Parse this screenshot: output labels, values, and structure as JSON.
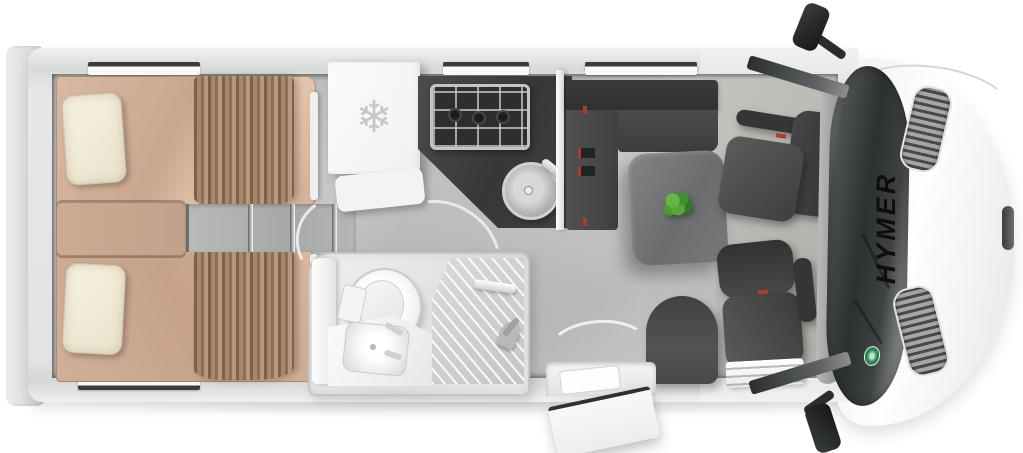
{
  "brand": {
    "label": "HYMER"
  },
  "fridge": {
    "icon_glyph": "❄"
  },
  "zones": {
    "vehicle": "Hymer motorhome top-view floor plan",
    "rear_bed_top": "Single bed with pillow and curtain",
    "rear_bed_bottom": "Single bed with pillow and curtain",
    "bed_steps": "Steps between twin beds",
    "fridge": "Refrigerator with freezer symbol",
    "kitchen": "Kitchen block with 3-burner gas hob and round sink",
    "bathroom": "Bathroom with toilet, washbasin and shower",
    "lounge": "L-shaped lounge seating with table and plant",
    "single_seat": "Single seat beside entry door",
    "swivel_seat_top": "Swivelled cab seat",
    "swivel_seat_bottom": "Swivelled cab seat",
    "entry_door": "Open entry door with step",
    "cab": "Driver cab with windshield and hood",
    "mirror_top": "Side mirror",
    "mirror_bottom": "Side mirror"
  },
  "colors": {
    "body_white": "#f4f5f4",
    "wall_gray": "#dfe1e0",
    "floor_gray": "#bfc1c0",
    "mattress_tan": "#cbaa92",
    "pillow_cream": "#f1ebd8",
    "curtain_brown": "#96765c",
    "upholstery_charcoal": "#454847",
    "table_gray": "#707372",
    "plant_green": "#4f9e35",
    "accent_red": "#b03a2e",
    "windshield_dark": "#2e3132",
    "badge_green": "#2f8f5b"
  }
}
